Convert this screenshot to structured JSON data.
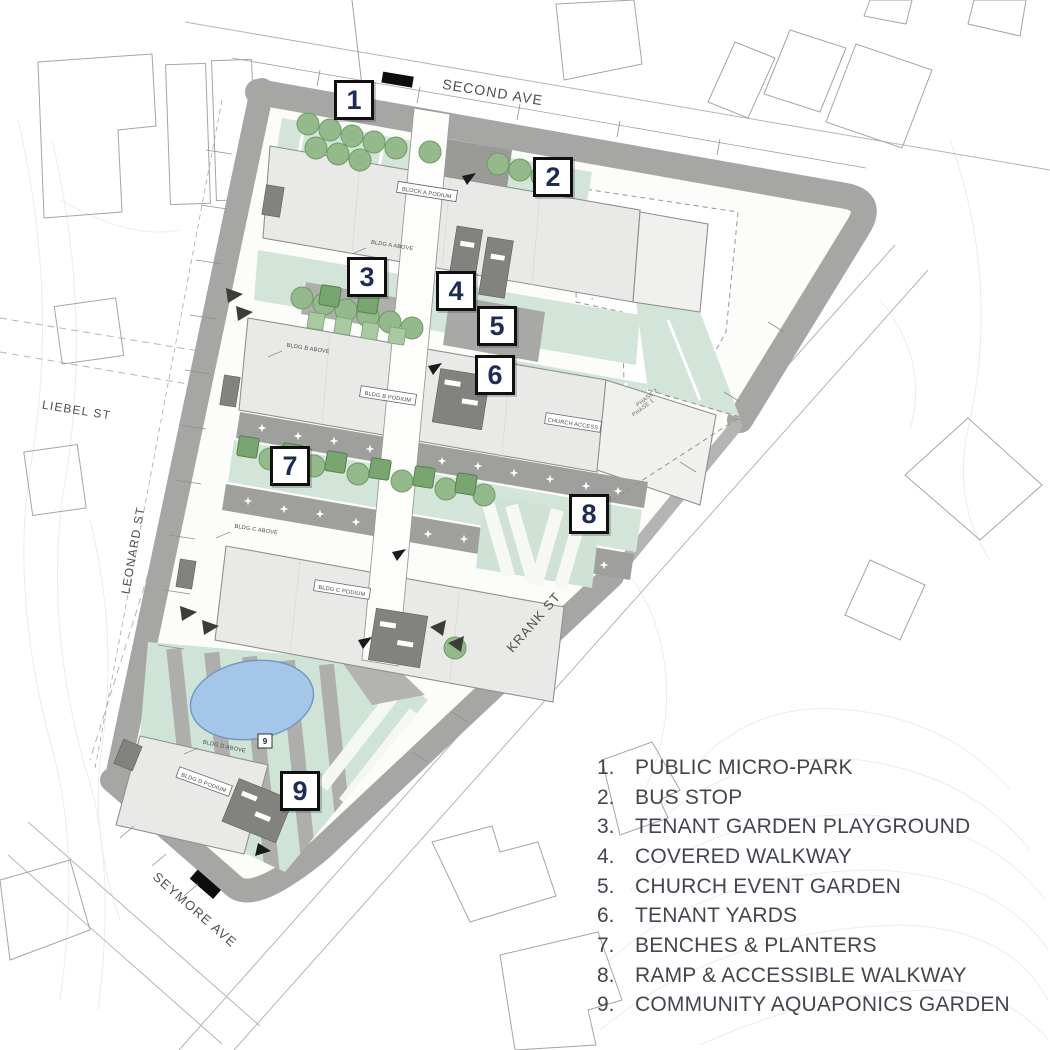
{
  "plan": {
    "streets": {
      "second_ave": "SECOND AVE",
      "liebel_st": "LIEBEL ST",
      "leonard_st": "LEONARD ST",
      "seymore_ave": "SEYMORE AVE",
      "krank_st": "KRANK ST"
    },
    "phases": {
      "phase2": "PHASE 2",
      "phase1": "PHASE 1"
    },
    "buildings": {
      "block_a_podium": "BLOCK A PODIUM",
      "bldg_a_above": "BLDG A ABOVE",
      "bldg_b_podium": "BLDG B PODIUM",
      "bldg_b_above": "BLDG B ABOVE",
      "bldg_c_podium": "BLDG C PODIUM",
      "bldg_c_above": "BLDG C ABOVE",
      "bldg_d_podium": "BLDG D PODIUM",
      "bldg_d_above": "BLDG D ABOVE",
      "church_access": "CHURCH ACCESS",
      "keynote_9": "9"
    }
  },
  "callouts": [
    {
      "number": "1"
    },
    {
      "number": "2"
    },
    {
      "number": "3"
    },
    {
      "number": "4"
    },
    {
      "number": "5"
    },
    {
      "number": "6"
    },
    {
      "number": "7"
    },
    {
      "number": "8"
    },
    {
      "number": "9"
    }
  ],
  "legend": {
    "items": [
      {
        "num": "1.",
        "label": "PUBLIC MICRO-PARK"
      },
      {
        "num": "2.",
        "label": "BUS STOP"
      },
      {
        "num": "3.",
        "label": "TENANT GARDEN PLAYGROUND"
      },
      {
        "num": "4.",
        "label": "COVERED WALKWAY"
      },
      {
        "num": "5.",
        "label": "CHURCH EVENT GARDEN"
      },
      {
        "num": "6.",
        "label": "TENANT YARDS"
      },
      {
        "num": "7.",
        "label": "BENCHES & PLANTERS"
      },
      {
        "num": "8.",
        "label": "RAMP & ACCESSIBLE WALKWAY"
      },
      {
        "num": "9.",
        "label": "COMMUNITY AQUAPONICS GARDEN"
      }
    ]
  },
  "colors": {
    "sidewalk": "#a6a6a4",
    "lawn_mint": "#d3e5d8",
    "tree_green": "#94ba8b",
    "planter_green": "#79a571",
    "building_fill": "#e9eae7",
    "core_gray": "#82827e",
    "pond_blue": "#a3c6e9",
    "callout_number": "#1e2c55",
    "legend_text": "#42464e"
  }
}
